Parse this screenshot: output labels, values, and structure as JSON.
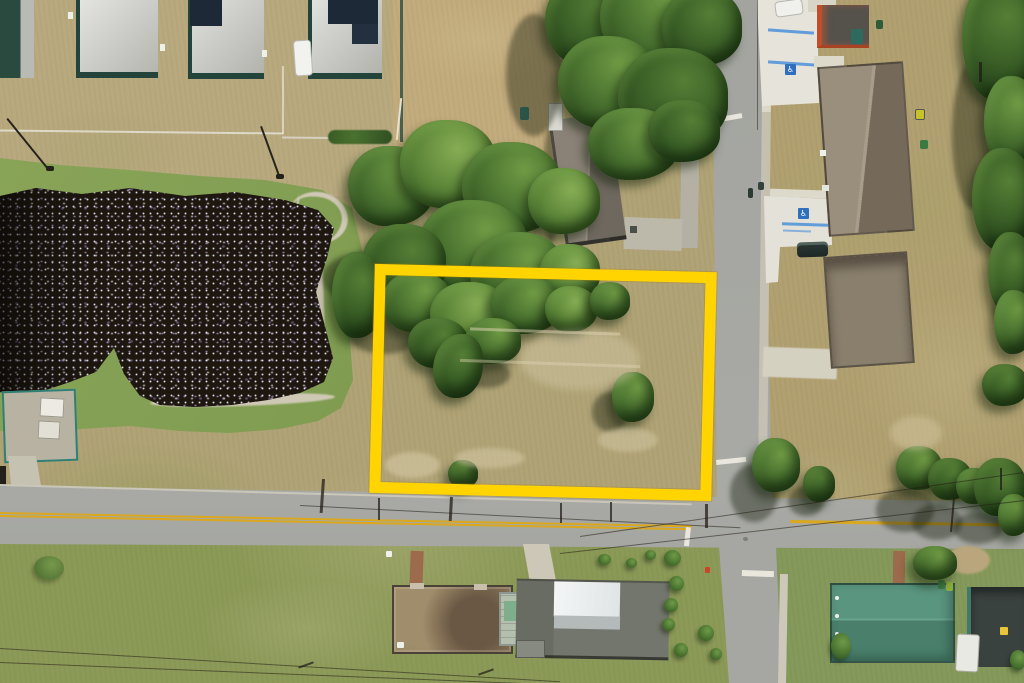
{
  "scene": {
    "title": "Aerial drone photograph of a vacant corner residential lot outlined in yellow",
    "regions": {
      "pond": "dark retention pond with sun sparkle",
      "vacant_lot": "vacant corner lot inside yellow boundary",
      "horizontal_road": "two-lane road with double yellow center line",
      "vertical_road": "residential side street",
      "new_homes": "row of new homes with rooftop solar panels",
      "neighborhood": "single-family homes with lawns and trees"
    }
  },
  "boundary": {
    "shape": "rectangle",
    "color": "#ffd400"
  },
  "markings": {
    "handicap_symbol": "♿"
  },
  "palette": {
    "boundary_yellow": "#ffd400",
    "asphalt_gray": "#a8a9a4",
    "center_line_yellow": "#d9a81f",
    "pond_dark": "#1d1710",
    "sparkle_lavender": "#b9a9df",
    "grass_green": "#86a156",
    "grass_dry": "#b3a478",
    "dirt_sand": "#c2ab7c",
    "roof_light_gray": "#d3d4d0",
    "solar_panel_navy": "#1d2936",
    "wall_teal": "#24433b",
    "roof_brown": "#9a8e7c",
    "roof_teal_green": "#559079",
    "roof_dark_charcoal": "#3a423f",
    "metal_roof_white": "#eef1f1",
    "parking_stripe_blue": "#4a90d9",
    "hydrant_red": "#cc4526"
  }
}
